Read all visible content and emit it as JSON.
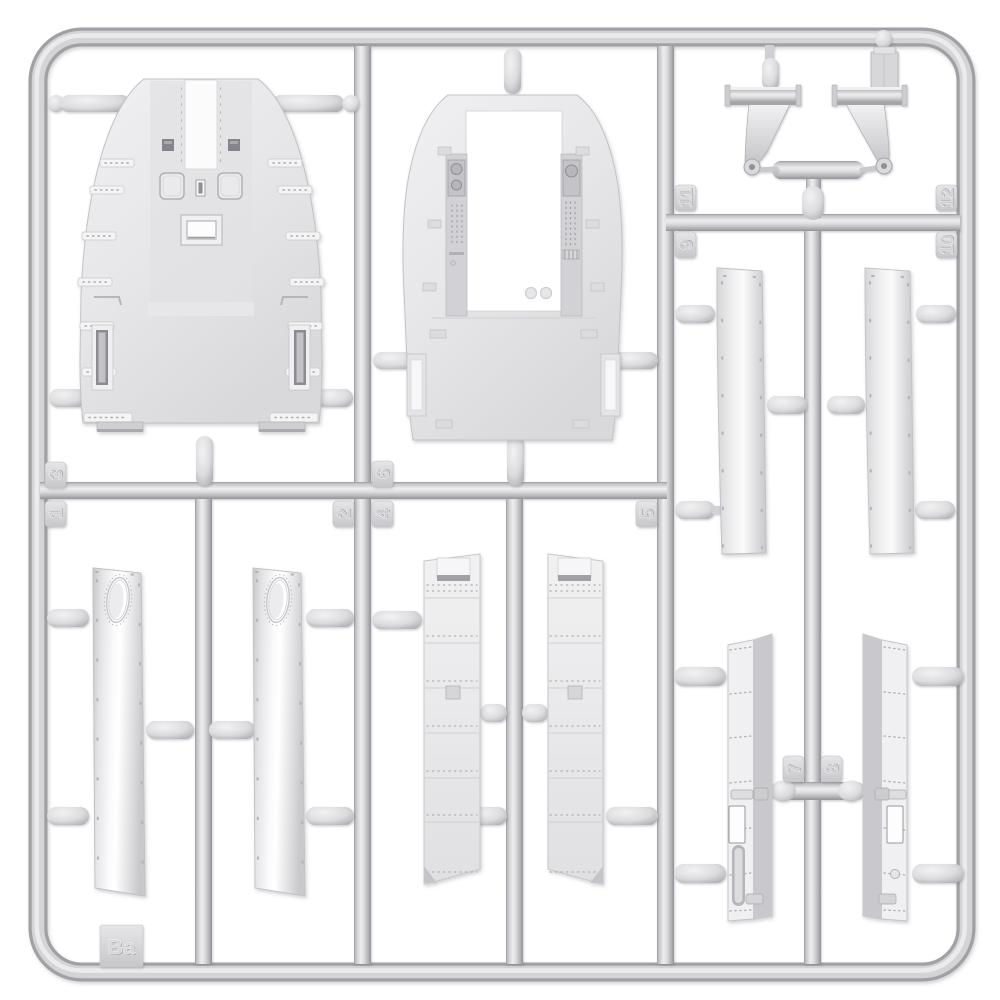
{
  "sprue": {
    "letter_label": "Ba",
    "part_tags": {
      "t1": {
        "label": "1"
      },
      "t2": {
        "label": "2"
      },
      "t3": {
        "label": "3"
      },
      "t4": {
        "label": "4"
      },
      "t5": {
        "label": "5"
      },
      "t6": {
        "label": "6"
      },
      "t7": {
        "label": "7"
      },
      "t8": {
        "label": "8"
      },
      "t9": {
        "label": "9"
      },
      "t10": {
        "label": "10"
      },
      "t11": {
        "label": "11"
      },
      "t12": {
        "label": "12"
      }
    },
    "colors": {
      "background": "#ffffff",
      "plastic_base": "#dadadd",
      "plastic_highlight": "#f1f1f3",
      "plastic_shadow": "#97979c",
      "tag_text": "#cccccf"
    }
  }
}
